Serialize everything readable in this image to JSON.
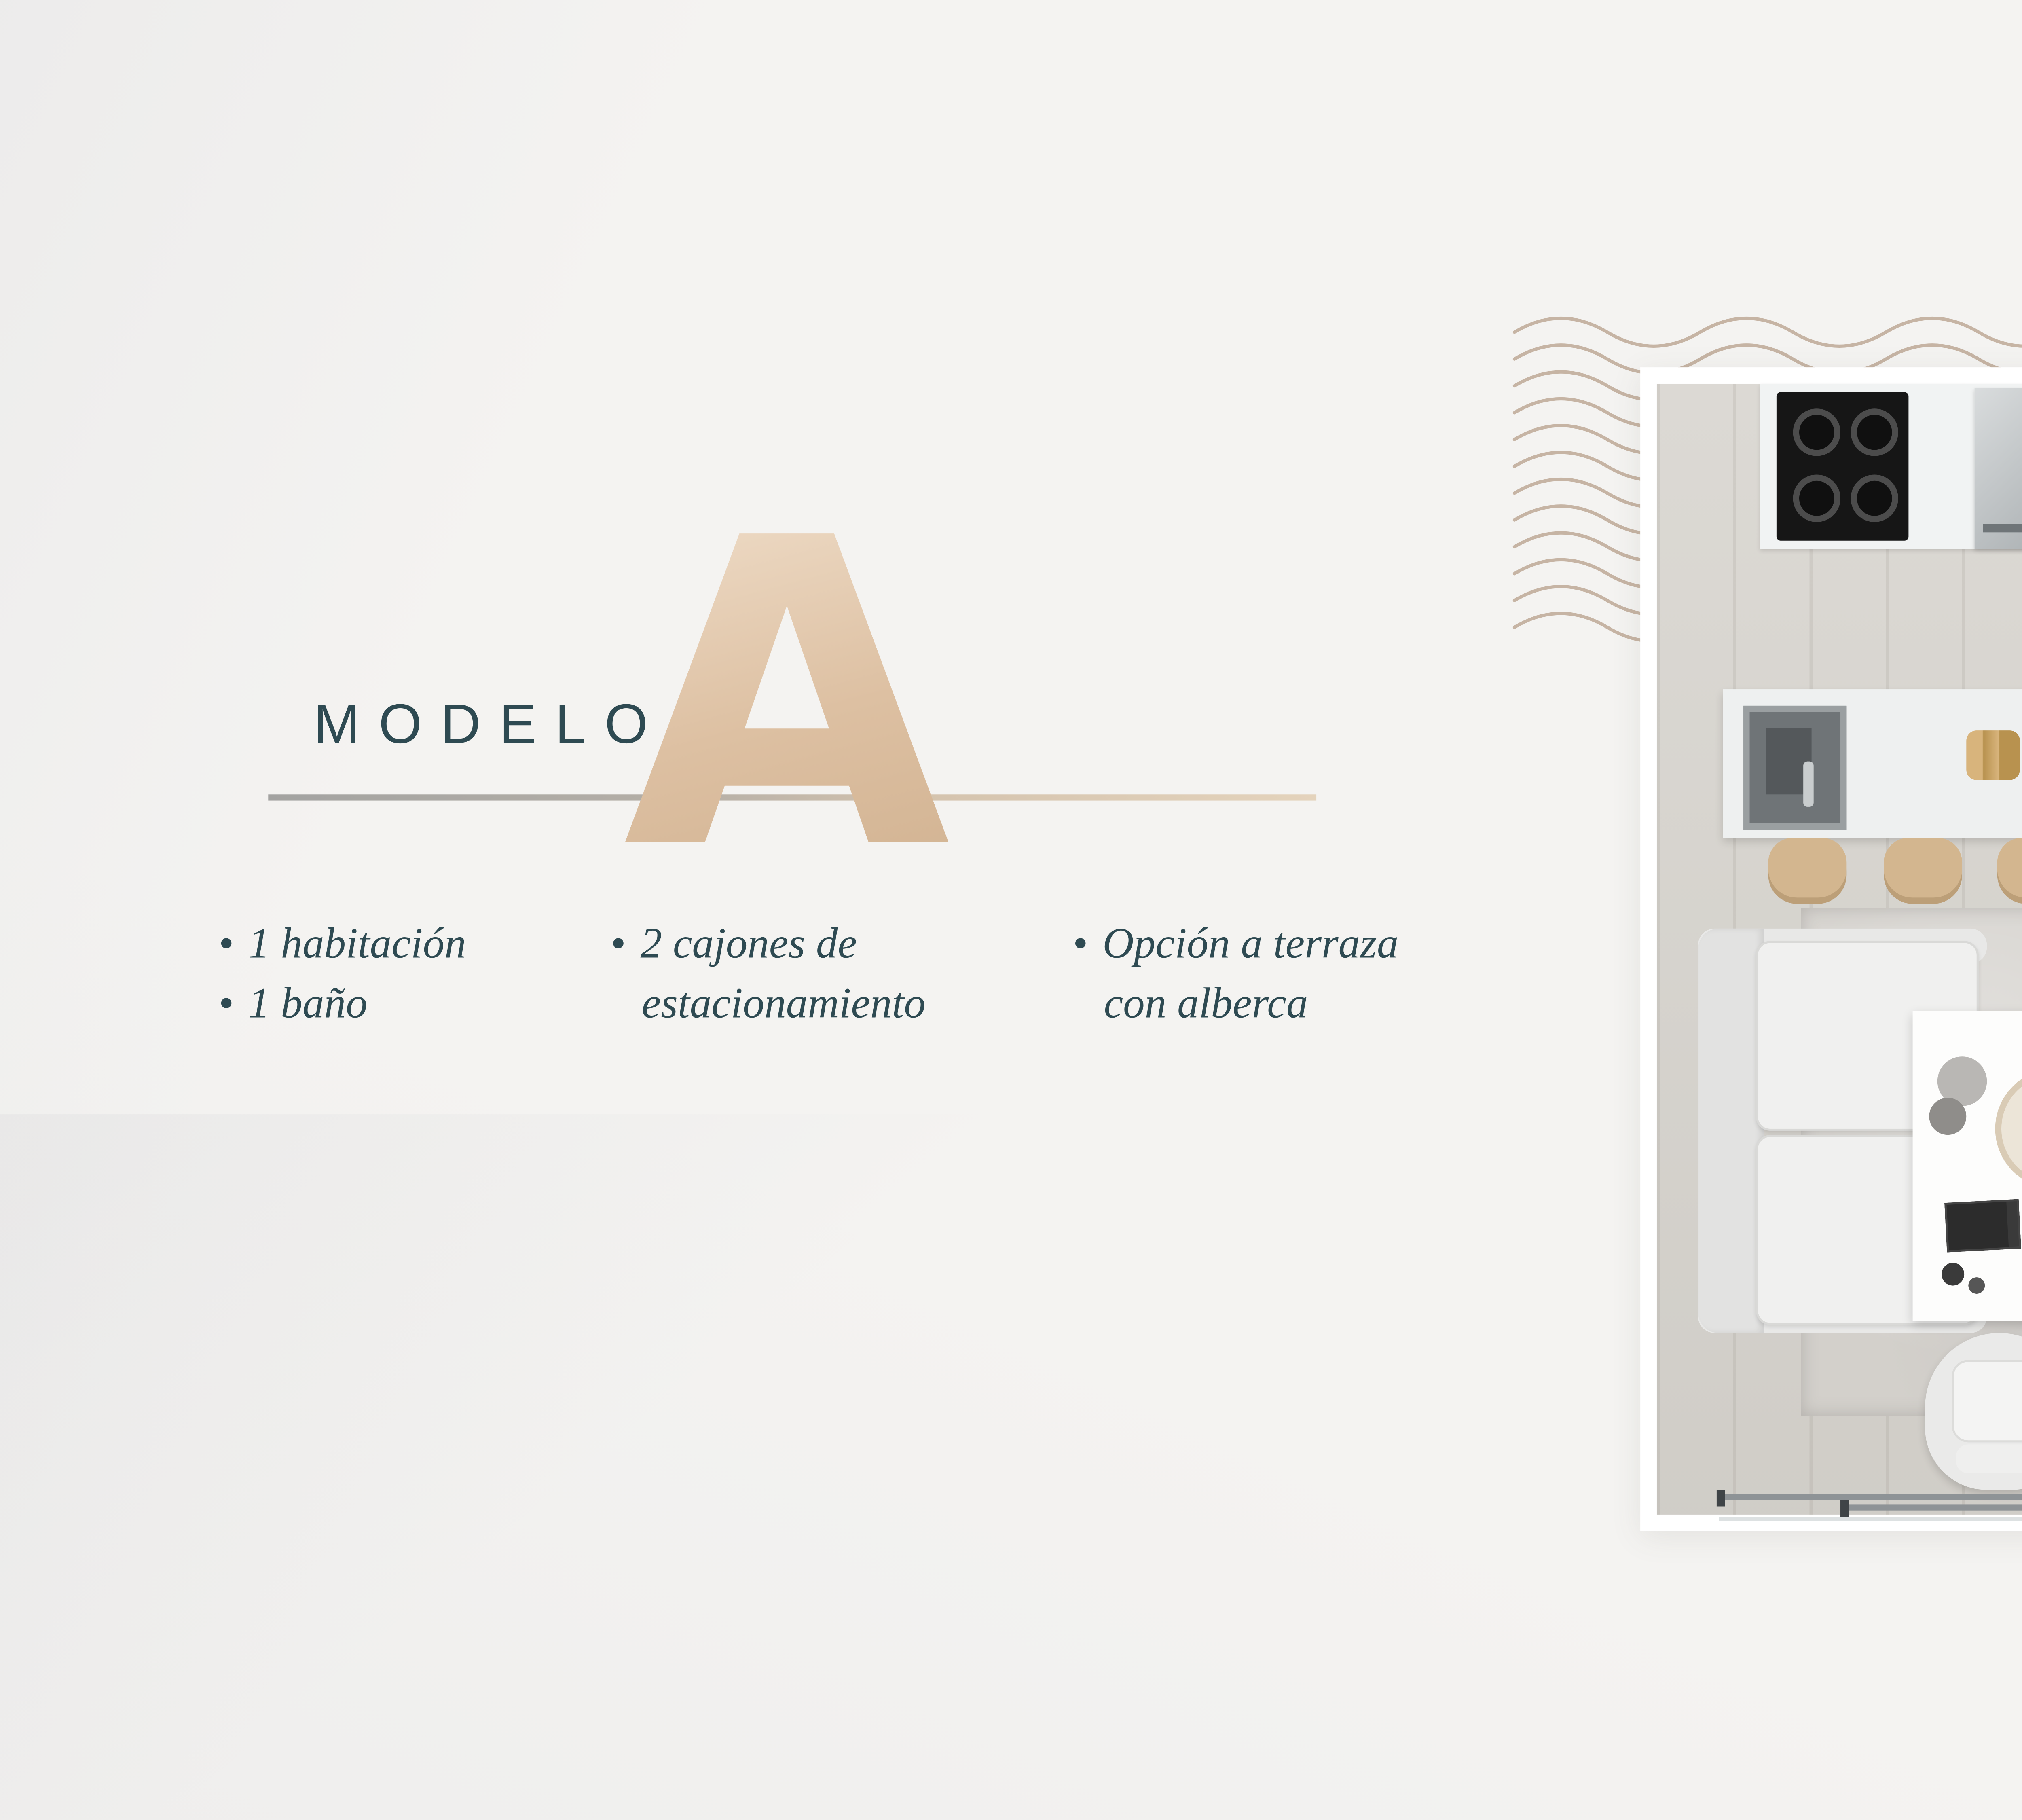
{
  "model": {
    "label": "MODELO",
    "letter": "A"
  },
  "bullet_char": "•",
  "features": {
    "col1": {
      "line1": "1 habitación",
      "line2": "1 baño"
    },
    "col2": {
      "line1": "2 cajones de",
      "line2": "estacionamiento"
    },
    "col3": {
      "line1": "Opción a terraza",
      "line2": "con alberca"
    }
  },
  "plan": {
    "entry_label": "INGRESO",
    "compass_label": "N",
    "disclaimer": "* PLANO DE REFERENCIA  PARA FINES ILUSTRATIVOS"
  },
  "colors": {
    "accent_teal": "#2e4a52",
    "accent_beige": "#d9c0a7",
    "wave_tan": "#c6b4a4",
    "muted_gray": "#9d9a97"
  }
}
